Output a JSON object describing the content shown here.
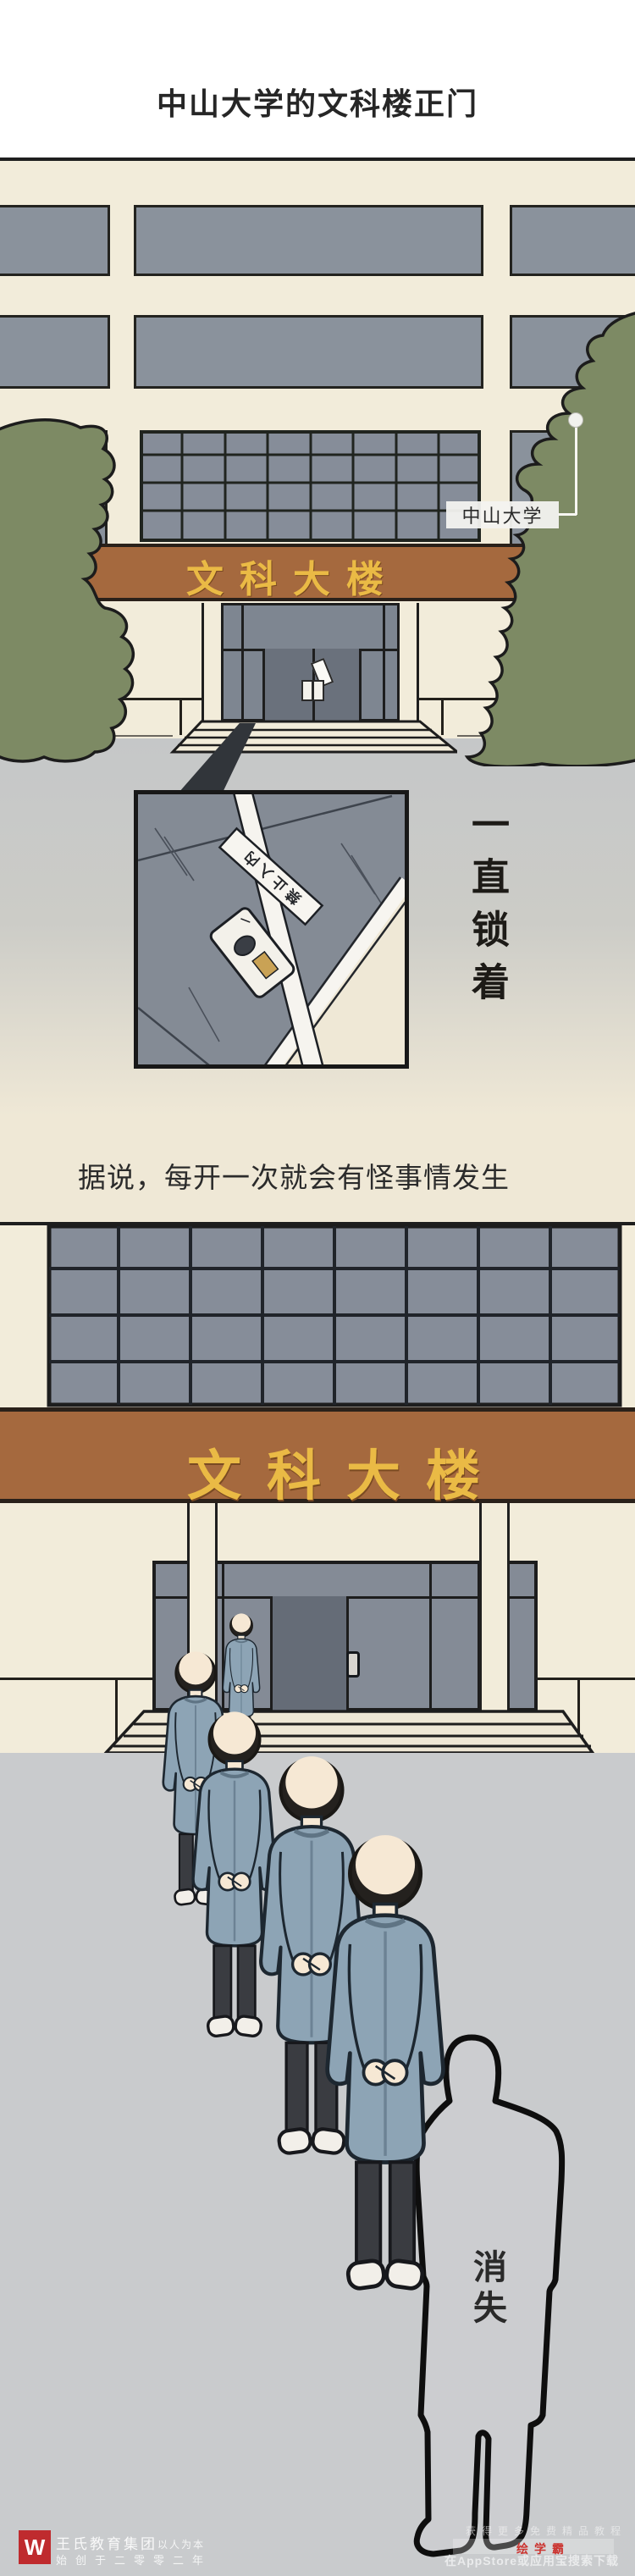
{
  "page": {
    "title": "中山大学的文科楼正门"
  },
  "scene1": {
    "banner_text": "文科大楼",
    "callout": {
      "label": "中山大学"
    },
    "inset": {
      "seal_text": "禁止入内"
    },
    "locked_note": "一直锁着"
  },
  "caption": {
    "text": "据说，每开一次就会有怪事情发生"
  },
  "scene2": {
    "banner_text": "文科大楼",
    "disappear_note": "消失"
  },
  "footer": {
    "left": {
      "logo_letter": "W",
      "brand": "王氏教育集团",
      "slogan": "以人为本",
      "subline": "始创于二零零二年"
    },
    "right": {
      "line1": "获得更多免费精品教程",
      "brand": "绘学霸",
      "line3": "在AppStore或应用宝搜索下载"
    }
  },
  "colors": {
    "cream": "#f2ecda",
    "beige": "#efe8d6",
    "window_gray": "#8a929c",
    "banner_brown": "#a5693e",
    "banner_gold": "#eaba45",
    "tree_olive": "#7d8a64",
    "ground_gray": "#c9cbcd",
    "coat_blue": "#8da4b5",
    "logo_red": "#bf2b2e",
    "accent_red": "#cb3430",
    "ink": "#1d1d1d"
  }
}
